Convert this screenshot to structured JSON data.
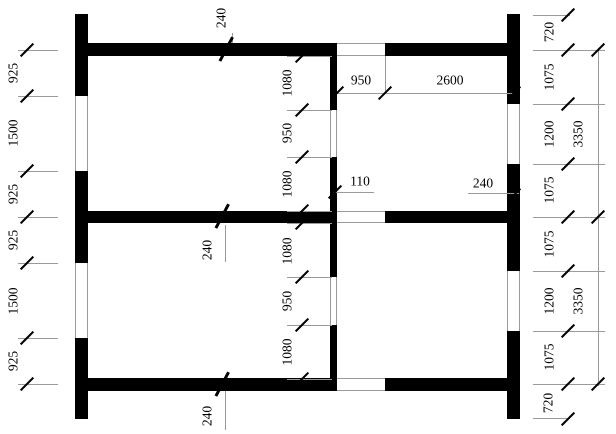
{
  "drawing": {
    "kind": "wall-plan",
    "colors": {
      "wall": "#000000",
      "dim_line": "#9a9a9a",
      "text": "#000000",
      "background": "#ffffff"
    },
    "dims": {
      "left_chain": [
        "925",
        "1500",
        "925",
        "925",
        "1500",
        "925"
      ],
      "inner_chain": [
        "1080",
        "950",
        "1080",
        "1080",
        "950",
        "1080"
      ],
      "right_inner_chain": [
        "720",
        "1075",
        "1200",
        "1075",
        "1075",
        "1200",
        "1075",
        "720"
      ],
      "right_outer_chain": [
        "3350",
        "3350"
      ],
      "top_chain": [
        "950",
        "2600"
      ],
      "callouts": {
        "top_wall": "240",
        "middle_wall": "240",
        "bottom_wall": "240",
        "interior_wall": "110",
        "right_wall": "240"
      }
    }
  }
}
